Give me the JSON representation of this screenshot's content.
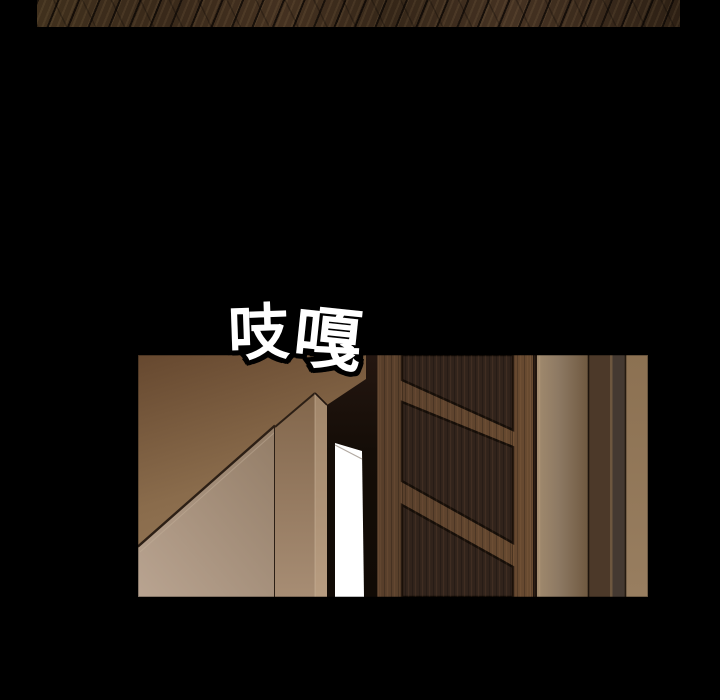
{
  "sfx": {
    "full_text": "吱嘎",
    "characters": [
      "吱",
      "嘎"
    ],
    "fill": "#ffffff",
    "outline": "#000000"
  },
  "palette": {
    "background": "#000000",
    "floor_wood": "#39291a",
    "floor_seam": "#150d07",
    "wall_upper_dark": "#684a31",
    "wall_upper_light": "#9f8261",
    "wall_lower_light": "#b9a491",
    "doorway_shadow": "#150d08",
    "light_gap": "#ffffff",
    "door_wood": "#5d422e",
    "door_panel": "#31231b",
    "frame_band_tan": "#8d7963",
    "frame_band_dark": "#4c3929",
    "frame_band_dark2": "#443931",
    "frame_band_right": "#927857"
  }
}
